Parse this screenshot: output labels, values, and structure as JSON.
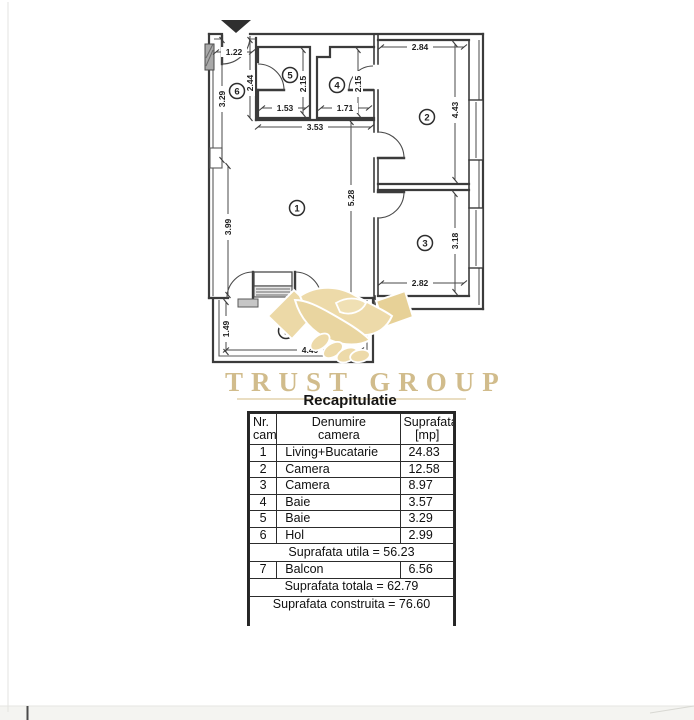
{
  "logo": {
    "text": "TRUST GROUP",
    "color": "#c9b178",
    "handshake_color": "#ecd9a7"
  },
  "plan": {
    "rooms": {
      "r1": "1",
      "r2": "2",
      "r3": "3",
      "r4": "4",
      "r5": "5",
      "r6": "6",
      "r7": "7"
    },
    "dims": {
      "hol_width": "1.22",
      "hol_depth": "2.44",
      "hol_length": "3.29",
      "baie5_width": "1.53",
      "baie5_depth": "2.15",
      "baie4_width": "1.71",
      "baie4_depth": "2.15",
      "camera2_width": "2.84",
      "camera2_depth": "4.43",
      "living_width": "3.53",
      "living_depth": "5.28",
      "living_side": "3.99",
      "camera3_depth": "3.18",
      "camera3_width": "2.82",
      "balcon_depth": "1.49",
      "balcon_width": "4.40"
    }
  },
  "table": {
    "title": "Recapitulatie",
    "header": {
      "nr_line1": "Nr.",
      "nr_line2": "cam.",
      "name_line1": "Denumire",
      "name_line2": "camera",
      "area_line1": "Suprafata",
      "area_line2": "[mp]"
    },
    "rows": [
      {
        "nr": "1",
        "name": "Living+Bucatarie",
        "area": "24.83"
      },
      {
        "nr": "2",
        "name": "Camera",
        "area": "12.58"
      },
      {
        "nr": "3",
        "name": "Camera",
        "area": "8.97"
      },
      {
        "nr": "4",
        "name": "Baie",
        "area": "3.57"
      },
      {
        "nr": "5",
        "name": "Baie",
        "area": "3.29"
      },
      {
        "nr": "6",
        "name": "Hol",
        "area": "2.99"
      }
    ],
    "suprafata_utila": "Suprafata utila = 56.23",
    "balcon": {
      "nr": "7",
      "name": "Balcon",
      "area": "6.56"
    },
    "suprafata_totala": "Suprafata totala = 62.79",
    "suprafata_construita": "Suprafata construita = 76.60"
  }
}
